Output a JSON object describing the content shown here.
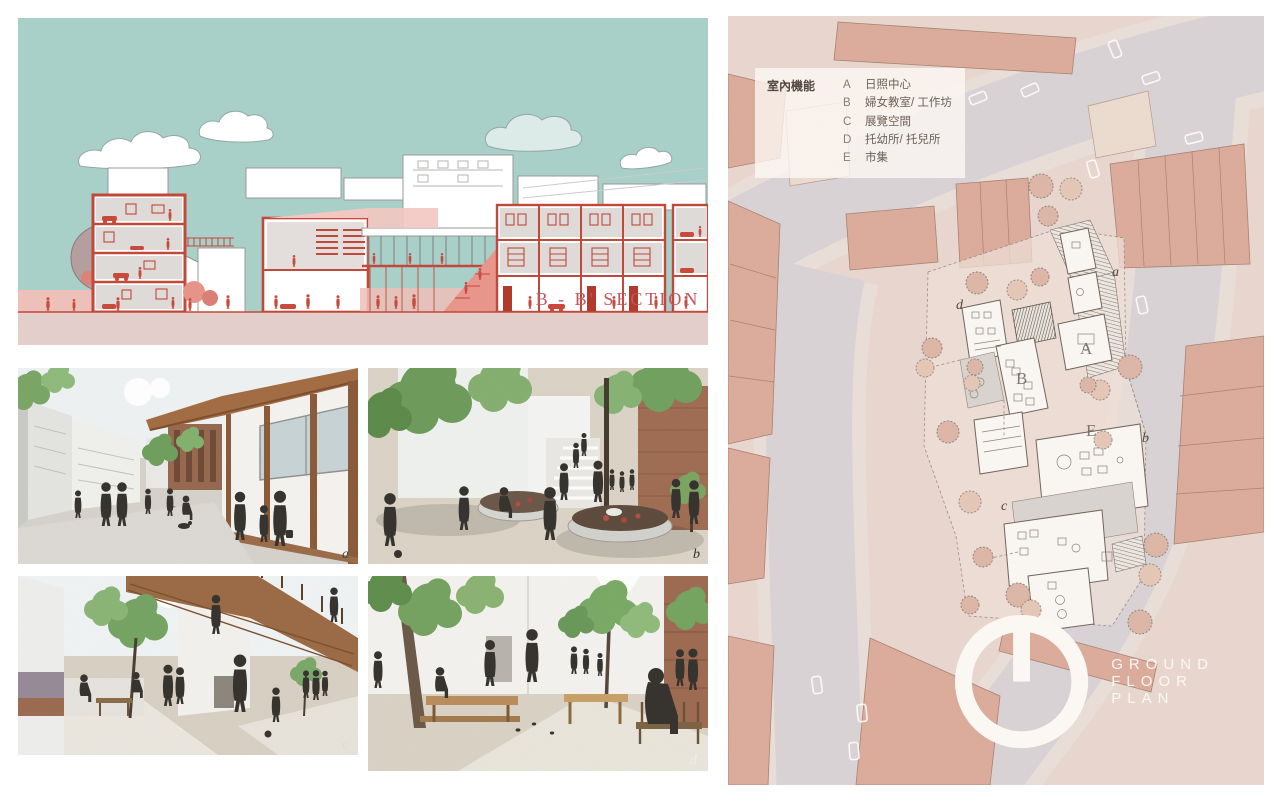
{
  "section": {
    "label": "B - B' SECTION"
  },
  "renders": [
    {
      "label": "a"
    },
    {
      "label": "b"
    },
    {
      "label": "c"
    },
    {
      "label": "d"
    }
  ],
  "plan": {
    "legend": {
      "title": "室內機能",
      "items": [
        {
          "key": "A",
          "label": "日照中心"
        },
        {
          "key": "B",
          "label": "婦女教室/ 工作坊"
        },
        {
          "key": "C",
          "label": "展覽空間"
        },
        {
          "key": "D",
          "label": "托幼所/ 托兒所"
        },
        {
          "key": "E",
          "label": "市集"
        }
      ]
    },
    "markers": {
      "a": "a",
      "b": "b",
      "c": "c",
      "d": "d"
    },
    "rooms": {
      "A": "A",
      "B": "B",
      "E": "E"
    },
    "footer": "GROUND FLOOR PLAN"
  },
  "colors": {
    "sky": "#a9cfc9",
    "section_red": "#c2483a",
    "ground_pink": "#e6cfcc",
    "plan_bg": "#e9d7cf",
    "road": "#d9d3d6",
    "building_salmon": "#dcab9a",
    "wood": "#9c6a44",
    "foliage": "#7aa768"
  }
}
